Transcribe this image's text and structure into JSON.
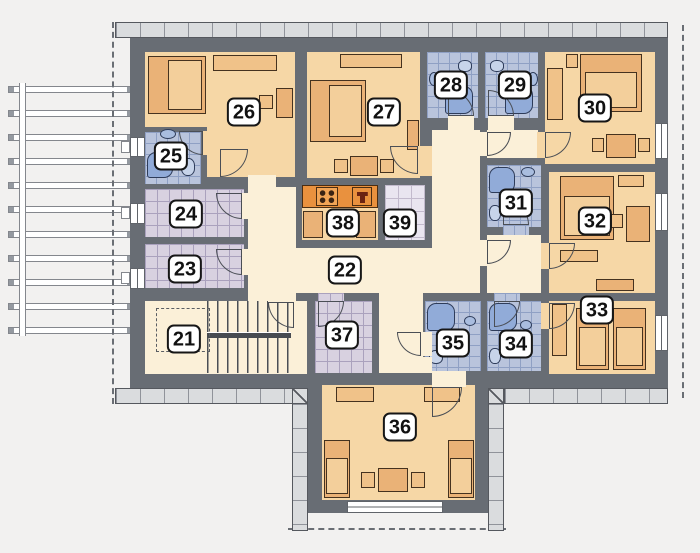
{
  "title": "Upper floor plan with numbered rooms",
  "rooms": [
    {
      "label": "21"
    },
    {
      "label": "22"
    },
    {
      "label": "23"
    },
    {
      "label": "24"
    },
    {
      "label": "25"
    },
    {
      "label": "26"
    },
    {
      "label": "27"
    },
    {
      "label": "28"
    },
    {
      "label": "29"
    },
    {
      "label": "30"
    },
    {
      "label": "31"
    },
    {
      "label": "32"
    },
    {
      "label": "33"
    },
    {
      "label": "34"
    },
    {
      "label": "35"
    },
    {
      "label": "36"
    },
    {
      "label": "37"
    },
    {
      "label": "38"
    },
    {
      "label": "39"
    }
  ],
  "palette": {
    "wall": "#686d74",
    "bedroom_floor": "#f6d7a6",
    "hall_floor": "#fbf0d8",
    "bathroom_tile": "#b9c4dc",
    "utility_tile": "#d8d1e0",
    "furniture": "#eab277",
    "fixture_blue": "#91abd8",
    "kitchen_counter": "#e9913e",
    "facade_band": "#dadcde",
    "background": "#f2f1f0"
  }
}
